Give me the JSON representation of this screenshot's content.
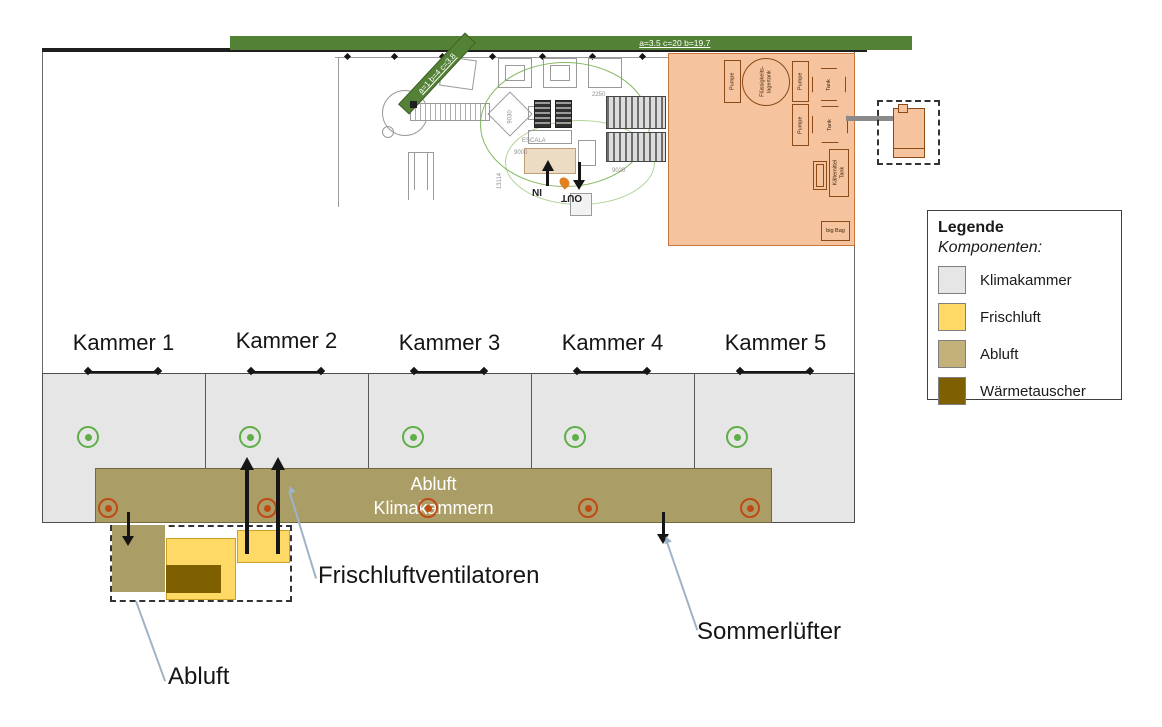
{
  "colors": {
    "green_bar": "#538135",
    "target_green": "#5fae47",
    "target_red": "#bf4a15",
    "klimakammer_gray": "#e7e6e6",
    "frischluft_yellow": "#ffd966",
    "abluft_band": "#ab9d66",
    "abluft_legend": "#c3b179",
    "waermetauscher_brown": "#7f6000",
    "plant_orange": "#f5c49e"
  },
  "dimension_bars": {
    "horizontal": "a=3.5 c=20 b=19.7",
    "diagonal": "a=1 b=4 c=3.8"
  },
  "chambers": {
    "items": [
      {
        "label": "Kammer 1"
      },
      {
        "label": "Kammer 2"
      },
      {
        "label": "Kammer 3"
      },
      {
        "label": "Kammer 4"
      },
      {
        "label": "Kammer 5"
      }
    ]
  },
  "exhaust_band": {
    "line1": "Abluft",
    "line2": "Klimakammern"
  },
  "callouts": {
    "frischluft": "Frischluftventilatoren",
    "sommerluefter": "Sommerlüfter",
    "abluft": "Abluft"
  },
  "cad": {
    "in_label": "IN",
    "out_label": "OUT",
    "dims": [
      "2250",
      "9030",
      "ESCALA",
      "9000",
      "9020",
      "13114"
    ]
  },
  "plant": {
    "pump1": "Pumpe",
    "pump2": "Pumpe",
    "pump3": "Pumpe",
    "tank1": "Tank",
    "tank2": "Tank",
    "vessel_line1": "Flüssigkeits-",
    "vessel_line2": "lagertank",
    "refrigerant_line1": "Kältemittel",
    "refrigerant_line2": "Tank",
    "big_bag": "big Bag"
  },
  "legend": {
    "title": "Legende",
    "subtitle": "Komponenten:",
    "items": [
      {
        "label": "Klimakammer",
        "color": "#e7e6e6",
        "swatch_style": "background:#e7e6e6"
      },
      {
        "label": "Frischluft",
        "color": "#ffd966",
        "swatch_style": "background:#ffd966"
      },
      {
        "label": "Abluft",
        "color": "#c3b179",
        "swatch_style": "background:#c3b179"
      },
      {
        "label": "Wärmetauscher",
        "color": "#7f6000",
        "swatch_style": "background:#7f6000"
      }
    ]
  }
}
